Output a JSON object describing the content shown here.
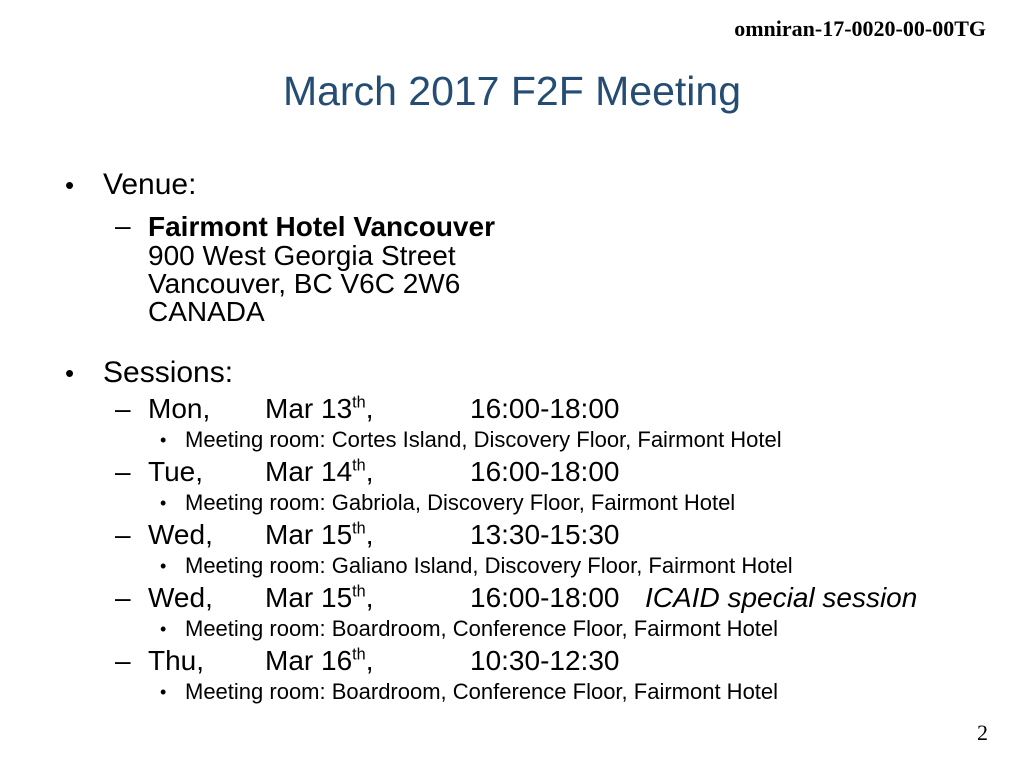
{
  "slide": {
    "doc_number": "omniran-17-0020-00-00TG",
    "title": "March 2017 F2F Meeting",
    "page_number": "2"
  },
  "colors": {
    "title_blue": "#254d74",
    "text": "#000000",
    "background": "#ffffff"
  },
  "bullets": {
    "level1": "•",
    "level2": "–",
    "level3": "•"
  },
  "venue": {
    "label": "Venue:",
    "hotel_name": "Fairmont Hotel Vancouver",
    "address_lines": [
      "900 West Georgia Street",
      "Vancouver, BC V6C 2W6",
      "CANADA"
    ]
  },
  "sessions": {
    "label": "Sessions:",
    "items": [
      {
        "day": "Mon,",
        "date": "Mar 13",
        "ordinal": "th",
        "after_date": ",",
        "time": "16:00-18:00",
        "note": "",
        "room": "Meeting room: Cortes Island, Discovery Floor, Fairmont Hotel"
      },
      {
        "day": "Tue,",
        "date": "Mar 14",
        "ordinal": "th",
        "after_date": ",",
        "time": "16:00-18:00",
        "note": "",
        "room": "Meeting room: Gabriola, Discovery Floor, Fairmont Hotel"
      },
      {
        "day": "Wed,",
        "date": "Mar 15",
        "ordinal": "th",
        "after_date": ",",
        "time": "13:30-15:30",
        "note": "",
        "room": "Meeting room: Galiano Island, Discovery Floor, Fairmont Hotel"
      },
      {
        "day": "Wed,",
        "date": "Mar 15",
        "ordinal": "th",
        "after_date": ",",
        "time": "16:00-18:00",
        "note": "ICAID special session",
        "room": "Meeting room: Boardroom, Conference Floor, Fairmont Hotel"
      },
      {
        "day": "Thu,",
        "date": "Mar 16",
        "ordinal": "th",
        "after_date": ",",
        "time": "10:30-12:30",
        "note": "",
        "room": "Meeting room: Boardroom, Conference Floor, Fairmont Hotel"
      }
    ]
  }
}
